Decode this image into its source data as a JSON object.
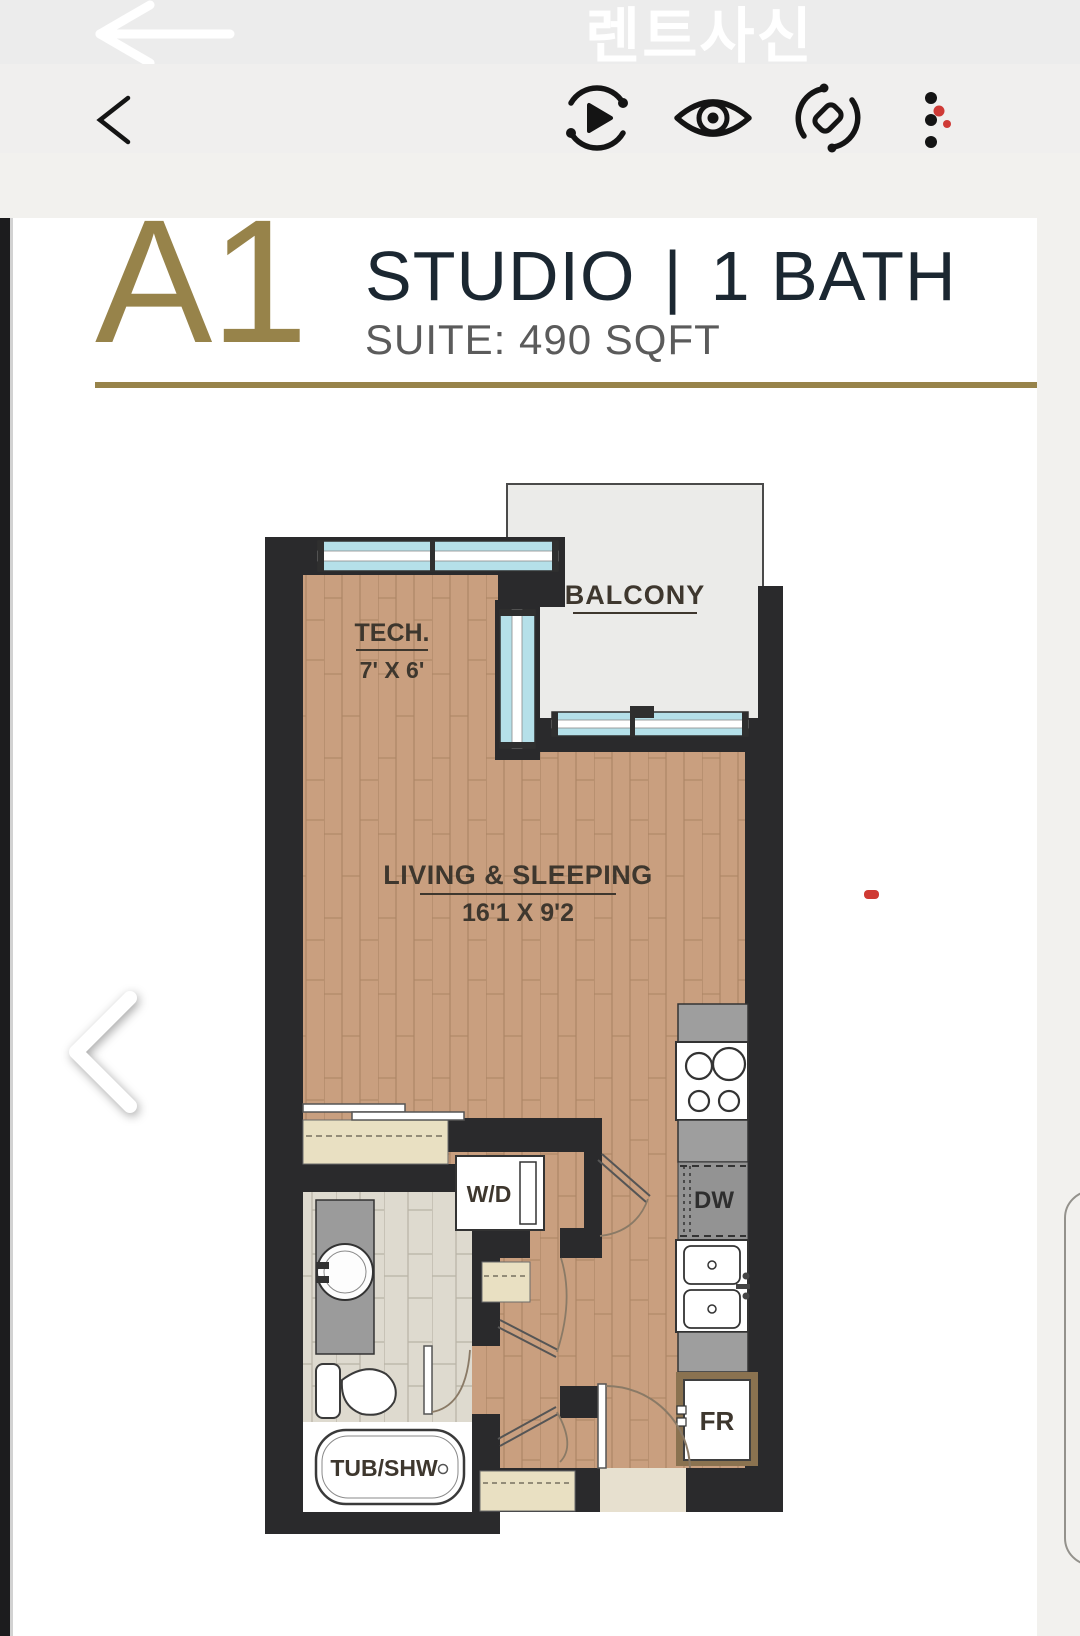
{
  "status_bar": {
    "app_title": "렌트사신",
    "back_icon": "arrow-left-icon"
  },
  "toolbar": {
    "back_icon": "chevron-left-icon",
    "actions": [
      {
        "name": "slideshow-play-icon"
      },
      {
        "name": "preview-eye-icon"
      },
      {
        "name": "rotate-object-icon"
      },
      {
        "name": "more-menu-icon",
        "badge_color": "#cf3a36"
      }
    ]
  },
  "listing_header": {
    "unit_code": "A1",
    "unit_type": "STUDIO",
    "separator": "|",
    "bath": "1 BATH",
    "suite": "SUITE: 490 SQFT",
    "accent_color": "#97834a"
  },
  "floor_plan": {
    "rooms": {
      "balcony": {
        "label": "BALCONY"
      },
      "tech": {
        "label": "TECH.",
        "dims": "7' X 6'"
      },
      "living": {
        "label": "LIVING & SLEEPING",
        "dims": "16'1 X 9'2"
      }
    },
    "fixtures": {
      "washer_dryer": "W/D",
      "dishwasher": "DW",
      "fridge": "FR",
      "tub": "TUB/SHW"
    },
    "colors": {
      "wall": "#2a2a2c",
      "wood_floor": "#c99f7f",
      "tile_floor": "#dedacf",
      "window": "#b5e0e9",
      "closet": "#e9e0c2",
      "counter": "#9e9e9e",
      "balcony_floor": "#ebebe9"
    }
  },
  "carousel": {
    "prev_icon": "chevron-left-icon",
    "marker_color": "#cf3a33"
  }
}
